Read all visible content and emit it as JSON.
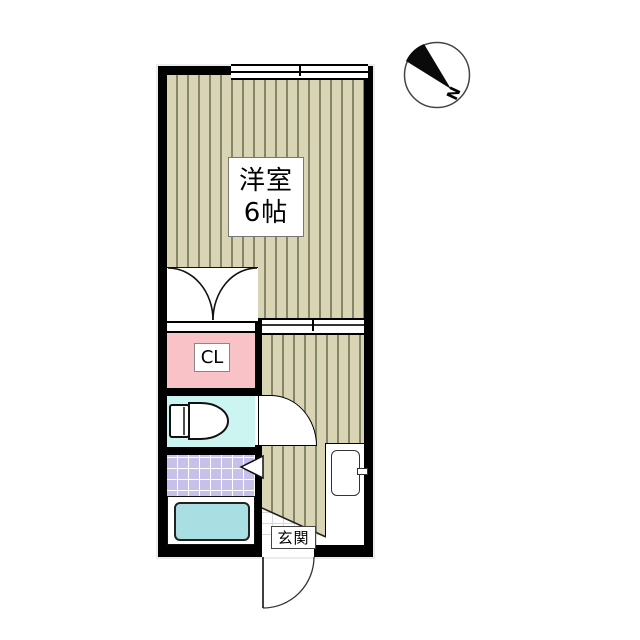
{
  "plan": {
    "main_room": {
      "line1": "洋室",
      "line2": "6帖"
    },
    "closet_label": "CL",
    "entrance_label": "玄関",
    "compass_label": "N"
  },
  "colors": {
    "wall": "#000000",
    "wood_floor": "#d9d5b4",
    "wood_stripe": "#85856a",
    "closet_pink": "#f9c2c6",
    "toilet_cyan": "#ccf4f1",
    "bath_tile_purple": "#c7c1e9",
    "bathtub_cyan": "#a9dee3",
    "entrance_tile_grid": "#d8d8d8"
  }
}
